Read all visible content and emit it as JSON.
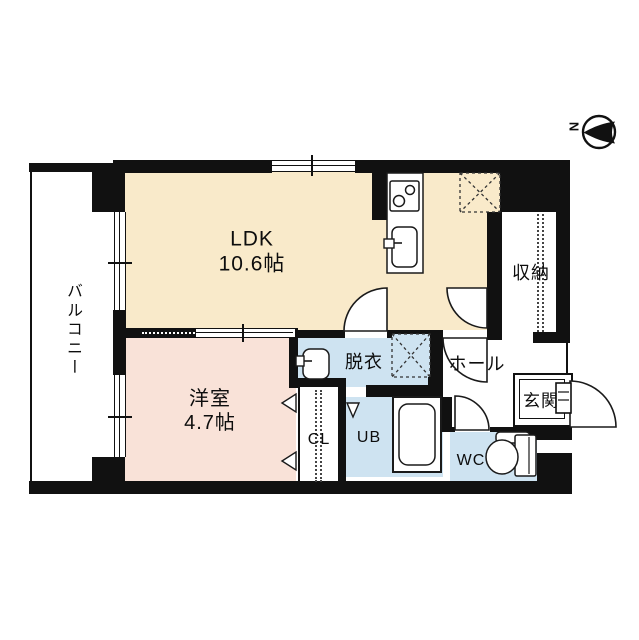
{
  "floor_plan": {
    "type": "apartment-floor-plan",
    "compass": {
      "label": "N",
      "direction": "north-points-left"
    },
    "rooms": {
      "balcony": {
        "label": "バルコニー"
      },
      "ldk": {
        "label": "LDK",
        "area": "10.6帖"
      },
      "western_room": {
        "label": "洋室",
        "area": "4.7帖"
      },
      "dressing": {
        "label": "脱衣"
      },
      "hall": {
        "label": "ホール"
      },
      "storage": {
        "label": "収納"
      },
      "entrance": {
        "label": "玄関"
      },
      "closet": {
        "label": "CL"
      },
      "unit_bath": {
        "label": "UB"
      },
      "toilet": {
        "label": "WC"
      }
    },
    "fixtures": [
      "kitchen-stove",
      "kitchen-sink",
      "washbasin",
      "bathtub",
      "toilet",
      "refrigerator-space",
      "washer-space"
    ],
    "colors": {
      "ldk_fill": "#F9EACA",
      "western_room_fill": "#F9E2D8",
      "wet_area_fill": "#CEE3F1",
      "wall": "#111111",
      "background": "#FFFFFF"
    }
  }
}
